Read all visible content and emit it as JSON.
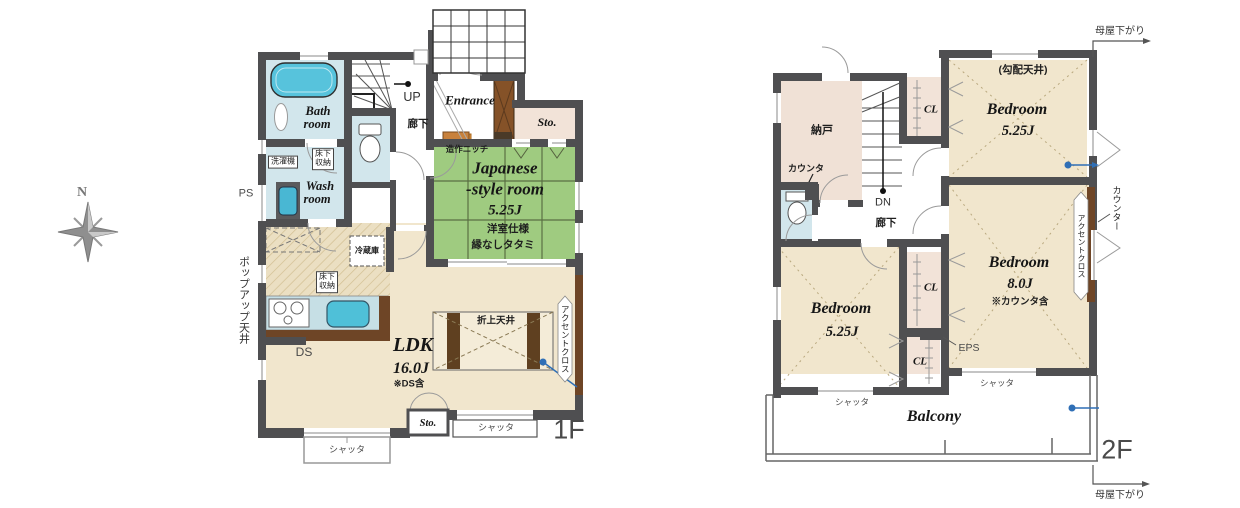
{
  "compass": {
    "north_label": "N"
  },
  "colors": {
    "wall": "#4f4f51",
    "tatami_green": "#9fcb80",
    "water_blue": "#d2e6ec",
    "tub_blue": "#57c3dc",
    "room_beige": "#f1e6cd",
    "closet_pink": "#f2e3d8",
    "accent_brown": "#6e4526",
    "marker_blue": "#2f6fb6",
    "step_orange": "#e2953f"
  },
  "floor1": {
    "floor_label": "1F",
    "entrance_label": "Entrance",
    "up_label": "UP",
    "hallway_label": "廊下",
    "storage_top_label": "Sto.",
    "storage_bottom_label": "Sto.",
    "niche_label": "造作ニッチ",
    "japanese_room": {
      "name_line1": "Japanese",
      "name_line2": "-style room",
      "size": "5.25J",
      "note_line1": "洋室仕様",
      "note_line2": "縁なしタタミ"
    },
    "bath_room": {
      "name_line1": "Bath",
      "name_line2": "room"
    },
    "wash_room": {
      "name_line1": "Wash",
      "name_line2": "room"
    },
    "washing_machine_label": "洗濯機",
    "underfloor_storage_wash_label": "床下\n収納",
    "underfloor_storage_kitchen_label": "床下\n収納",
    "ps_label": "PS",
    "popup_ceiling_label": "ポップアップ天井",
    "fridge_label": "冷蔵庫",
    "ds_label": "DS",
    "ldk": {
      "name": "LDK",
      "size": "16.0J",
      "note": "※DS含"
    },
    "folded_ceiling_label": "折上天井",
    "accent_cloth_label": "アクセントクロス",
    "shutter_left_label": "シャッタ",
    "shutter_right_label": "シャッタ"
  },
  "floor2": {
    "floor_label": "2F",
    "eaves_top_label": "母屋下がり",
    "eaves_bottom_label": "母屋下がり",
    "storeroom_label": "納戸",
    "counter_label": "カウンタ",
    "counter_right_label": "カウンター",
    "closet_top_label": "CL",
    "closet_mid_label": "CL",
    "closet_low_label": "CL",
    "dn_label": "DN",
    "hallway_label": "廊下",
    "sloped_ceiling_label": "(勾配天井)",
    "bedroom_ne": {
      "name": "Bedroom",
      "size": "5.25J"
    },
    "bedroom_sw": {
      "name": "Bedroom",
      "size": "5.25J"
    },
    "bedroom_se": {
      "name": "Bedroom",
      "size": "8.0J",
      "note": "※カウンタ含"
    },
    "accent_cloth_label": "アクセントクロス",
    "eps_label": "EPS",
    "shutter_sw_label": "シャッタ",
    "shutter_se_label": "シャッタ",
    "balcony_label": "Balcony"
  }
}
